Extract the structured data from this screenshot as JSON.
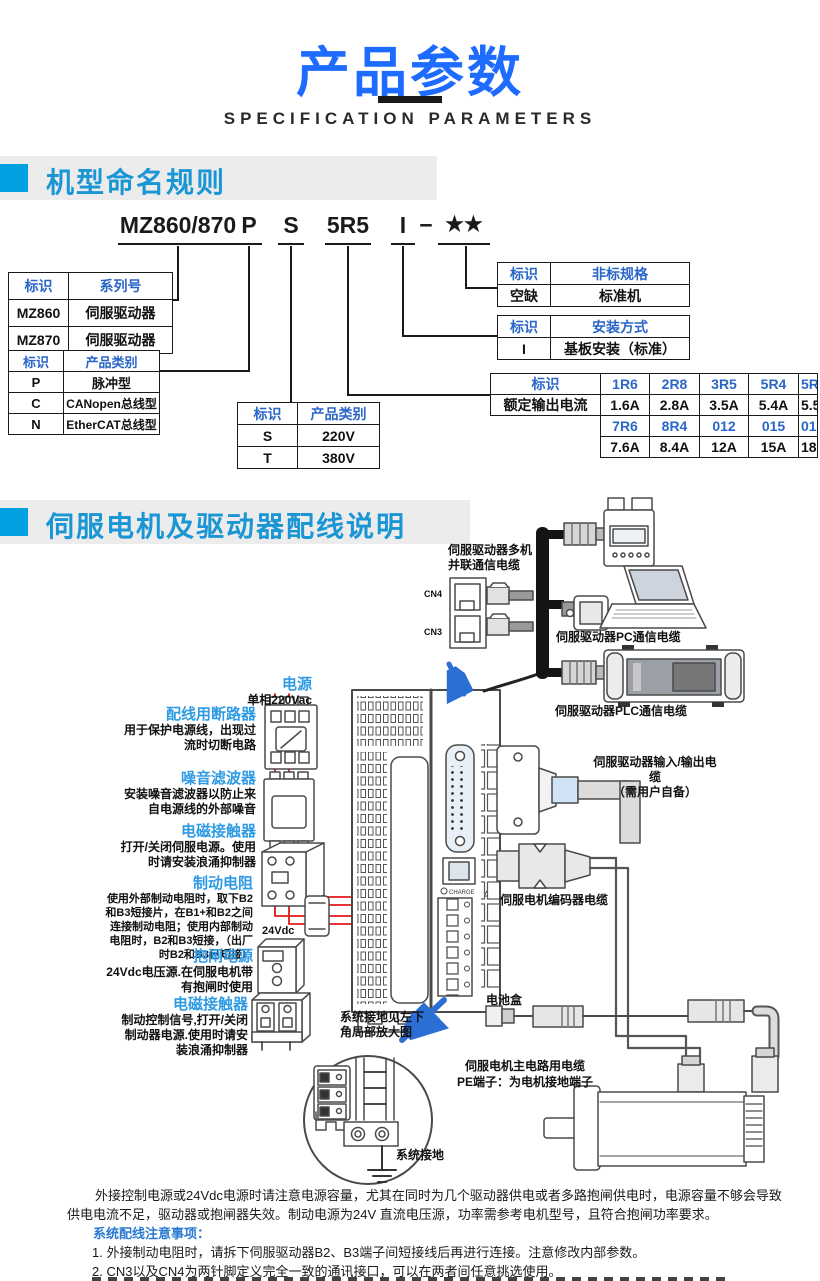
{
  "page": {
    "title": "产品参数",
    "subtitle": "SPECIFICATION PARAMETERS"
  },
  "section1": {
    "title": "机型命名规则"
  },
  "section2": {
    "title": "伺服电机及驱动器配线说明"
  },
  "model_code": {
    "parts": [
      "MZ860/870",
      "P",
      "S",
      "5R5",
      "I",
      "−",
      "★★"
    ]
  },
  "tables": {
    "series": {
      "h": [
        "标识",
        "系列号"
      ],
      "rows": [
        [
          "MZ860",
          "伺服驱动器"
        ],
        [
          "MZ870",
          "伺服驱动器"
        ]
      ]
    },
    "ptype": {
      "h": [
        "标识",
        "产品类别"
      ],
      "rows": [
        [
          "P",
          "脉冲型"
        ],
        [
          "C",
          "CANopen总线型"
        ],
        [
          "N",
          "EtherCAT总线型"
        ]
      ]
    },
    "volt": {
      "h": [
        "标识",
        "产品类别"
      ],
      "rows": [
        [
          "S",
          "220V"
        ],
        [
          "T",
          "380V"
        ]
      ]
    },
    "nonstd": {
      "h": [
        "标识",
        "非标规格"
      ],
      "rows": [
        [
          "空缺",
          "标准机"
        ]
      ]
    },
    "mount": {
      "h": [
        "标识",
        "安装方式"
      ],
      "rows": [
        [
          "I",
          "基板安装（标准）"
        ]
      ]
    },
    "current": {
      "label_id": "标识",
      "label_amp": "额定输出电流",
      "codes1": [
        "1R6",
        "2R8",
        "3R5",
        "5R4",
        "5R5"
      ],
      "amps1": [
        "1.6A",
        "2.8A",
        "3.5A",
        "5.4A",
        "5.5A"
      ],
      "codes2": [
        "7R6",
        "8R4",
        "012",
        "015",
        "018"
      ],
      "amps2": [
        "7.6A",
        "8.4A",
        "12A",
        "15A",
        "18A"
      ]
    }
  },
  "diagram": {
    "multi_comm_line1": "伺服驱动器多机",
    "multi_comm_line2": "并联通信电缆",
    "cn4": "CN4",
    "cn3": "CN3",
    "pc_cable": "伺服驱动器PC通信电缆",
    "plc_cable": "伺服驱动器PLC通信电缆",
    "power_title": "电源",
    "power_sub": "单相220Vac",
    "breaker_title": "配线用断路器",
    "breaker_desc": "用于保护电源线，出现过流时切断电路",
    "filter_title": "噪音滤波器",
    "filter_desc": "安装噪音滤波器以防止来自电源线的外部噪音",
    "contactor1_title": "电磁接触器",
    "contactor1_desc": "打开/关闭伺服电源。使用时请安装浪涌抑制器",
    "resistor_title": "制动电阻",
    "resistor_desc": "使用外部制动电阻时，取下B2和B3短接片，在B1+和B2之间连接制动电阻；使用内部制动电阻时，B2和B3短接，（出厂时B2和B3已短接）",
    "v24": "24Vdc",
    "brake_title": "抱闸电源",
    "brake_desc": "24Vdc电压源.在伺服电机带有抱闸时使用",
    "contactor2_title": "电磁接触器",
    "contactor2_desc": "制动控制信号,打开/关闭制动器电源.使用时请安装浪涌抑制器",
    "io_cable_line1": "伺服驱动器输入/输出电缆",
    "io_cable_line2": "（需用户自备）",
    "encoder_cable": "伺服电机编码器电缆",
    "battery": "电池盒",
    "ground_note_line1": "系统接地见左下",
    "ground_note_line2": "角局部放大图",
    "main_cable_line1": "伺服电机主电路用电缆",
    "main_cable_line2": "PE端子：为电机接地端子",
    "sys_ground": "系统接地",
    "charge": "CHARGE"
  },
  "notes": {
    "para_line1": "外接控制电源或24Vdc电源时请注意电源容量，尤其在同时为几个驱动器供电或者多路抱闸供电时，电源容量不够会导致",
    "para_line2": "供电电流不足，驱动器或抱闸器失效。制动电源为24V 直流电压源，功率需参考电机型号，且符合抱闸功率要求。",
    "heading": "系统配线注意事项：",
    "item1": "1. 外接制动电阻时，请拆下伺服驱动器B2、B3端子间短接线后再进行连接。注意修改内部参数。",
    "item2": "2. CN3以及CN4为两针脚定义完全一致的通讯接口，可以在两者间任意挑选使用。",
    "item3": "3. 在单相220V 配线中，主回路端子为 L1、L2，保留端子请勿进行接线。"
  },
  "colors": {
    "accent_blue": "#1d6bff",
    "section_blue": "#1b96d5",
    "square_blue": "#00a1e0",
    "table_blue": "#2a66c8",
    "label_blue": "#2e9be4",
    "wire_red": "#e01818",
    "arrow_blue": "#2b6fd4"
  }
}
